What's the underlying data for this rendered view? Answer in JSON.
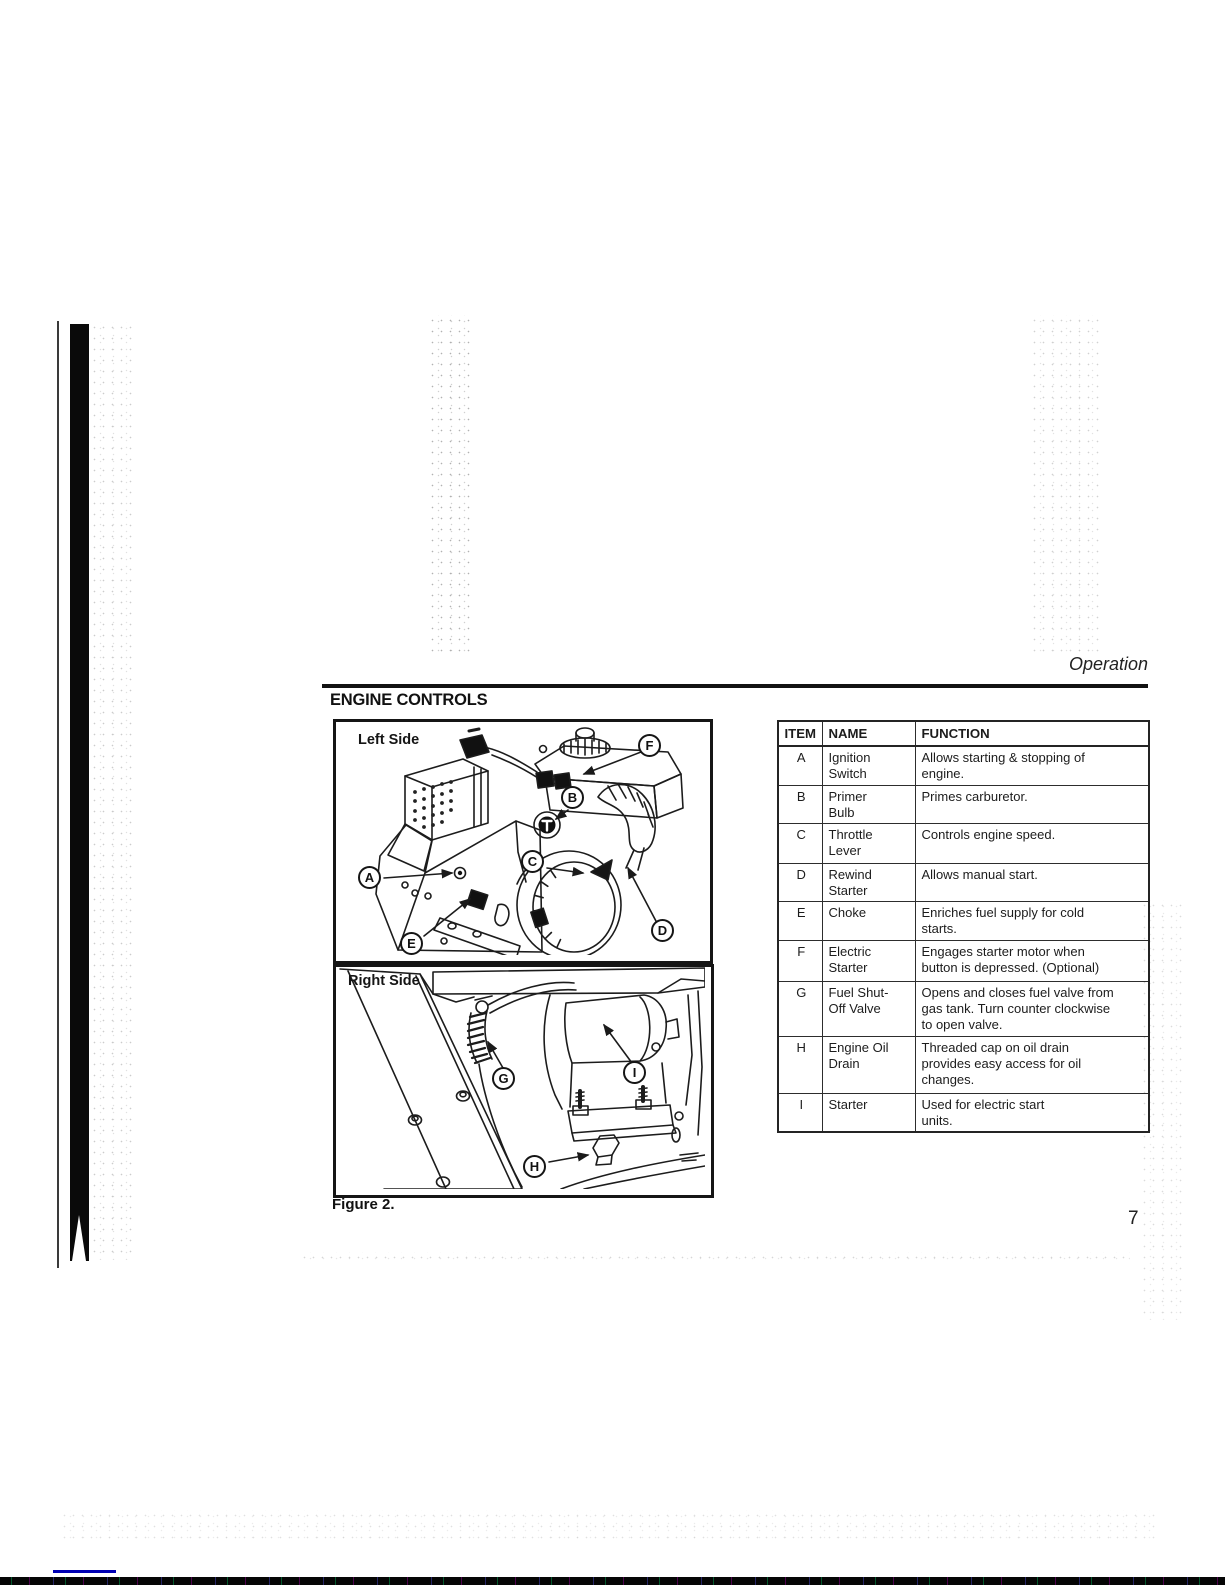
{
  "page": {
    "running_header": "Operation",
    "section_title": "ENGINE CONTROLS",
    "figure_caption": "Figure 2.",
    "page_number": "7"
  },
  "figure": {
    "left_label": "Left Side",
    "right_label": "Right Side",
    "callouts_left": [
      "A",
      "B",
      "C",
      "D",
      "E",
      "F"
    ],
    "callouts_right": [
      "G",
      "H",
      "I"
    ]
  },
  "table": {
    "headers": [
      "ITEM",
      "NAME",
      "FUNCTION"
    ],
    "rows": [
      {
        "item": "A",
        "name": "Ignition\nSwitch",
        "function": "Allows starting & stopping of\nengine."
      },
      {
        "item": "B",
        "name": "Primer\nBulb",
        "function": "Primes carburetor."
      },
      {
        "item": "C",
        "name": "Throttle\nLever",
        "function": "Controls engine speed."
      },
      {
        "item": "D",
        "name": "Rewind\nStarter",
        "function": "Allows manual start."
      },
      {
        "item": "E",
        "name": "Choke",
        "function": "Enriches fuel supply for cold\nstarts."
      },
      {
        "item": "F",
        "name": "Electric\nStarter",
        "function": "Engages starter motor when\nbutton is depressed. (Optional)"
      },
      {
        "item": "G",
        "name": "Fuel Shut-\nOff Valve",
        "function": "Opens and closes fuel valve from\ngas tank. Turn counter clockwise\nto open valve."
      },
      {
        "item": "H",
        "name": "Engine Oil\nDrain",
        "function": "Threaded cap on oil drain\nprovides easy access for oil\nchanges."
      },
      {
        "item": "I",
        "name": "Starter",
        "function": "Used for electric start\nunits."
      }
    ]
  }
}
